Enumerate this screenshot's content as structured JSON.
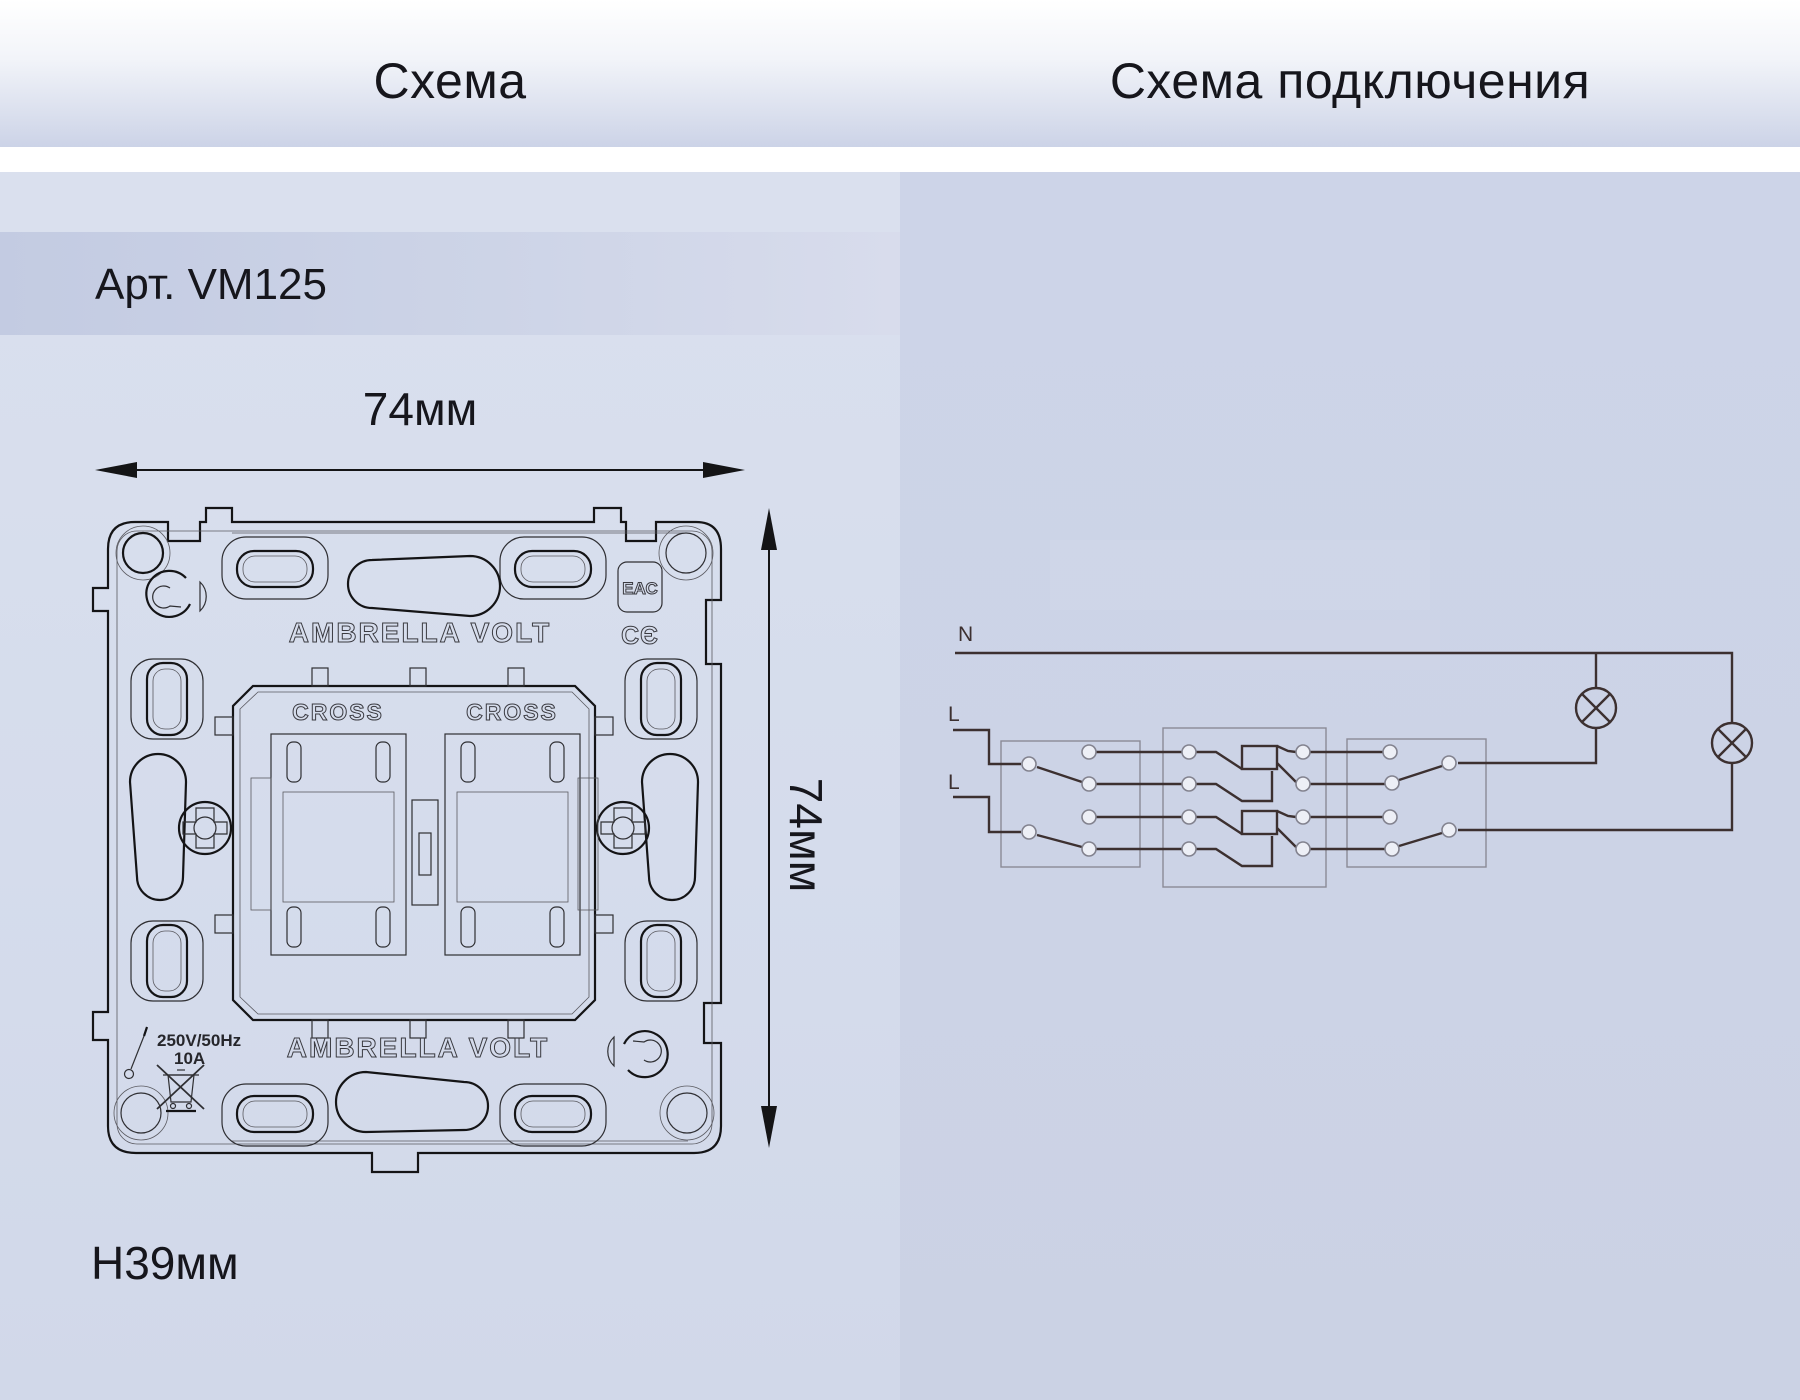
{
  "headers": {
    "left": "Схема",
    "right": "Схема подключения"
  },
  "article": {
    "label": "Арт. VM125"
  },
  "dimensions": {
    "width_top": "74мм",
    "height_right": "74мм",
    "depth": "H39мм"
  },
  "drawing": {
    "brand_top": "AMBRELLA VOLT",
    "brand_bottom": "AMBRELLA VOLT",
    "module1_label": "CROSS",
    "module2_label": "CROSS",
    "eac_mark": "ЕАС",
    "ce_mark": "СЄ",
    "rating_voltage": "250V/50Hz",
    "rating_current": "10A"
  },
  "schematic": {
    "neutral_label": "N",
    "line1_label": "L",
    "line2_label": "L"
  },
  "colors": {
    "header_gradient_top": "#ffffff",
    "header_gradient_bottom": "#ccd3e7",
    "left_panel": "#d6dcec",
    "right_panel": "#ccd3e6",
    "article_strip": "#c3cbe2",
    "text": "#16161c",
    "wire": "#3c3030",
    "schematic_box": "#8a8a96"
  }
}
